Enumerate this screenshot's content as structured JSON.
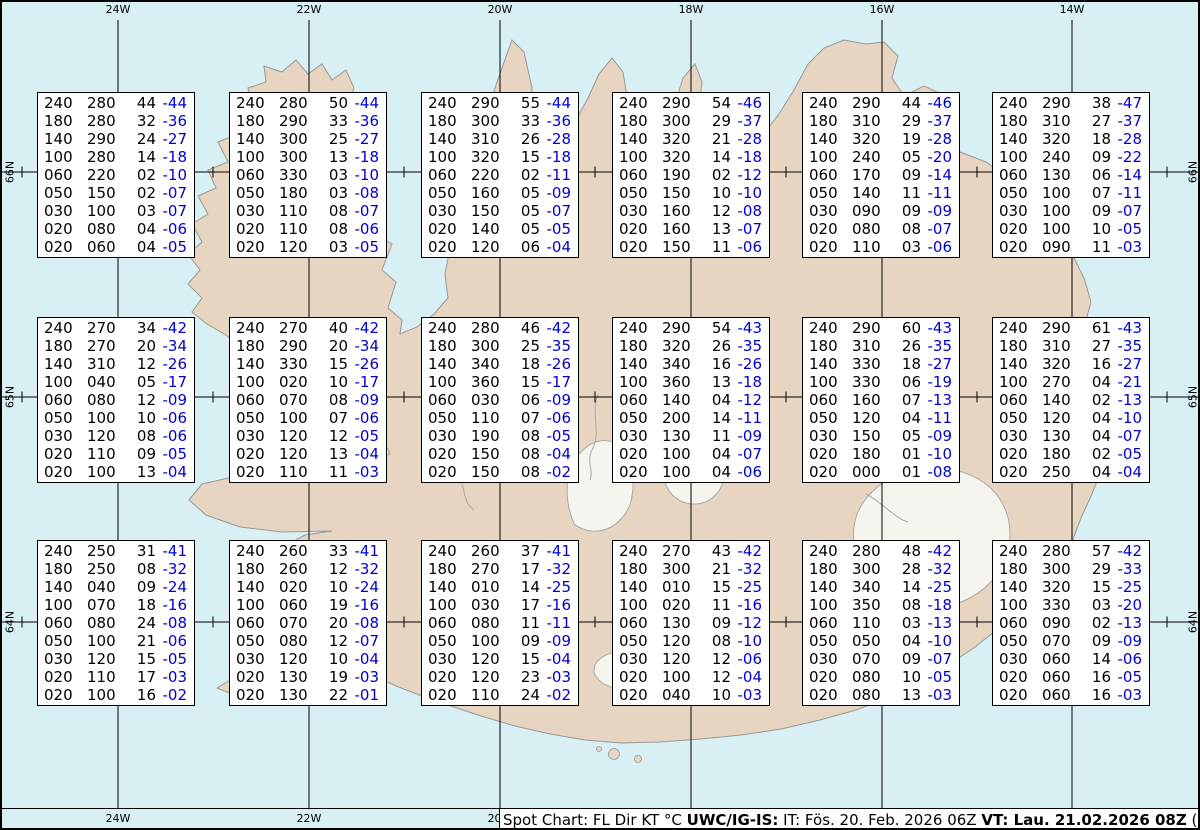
{
  "title": "Spot Chart: FL Dir KT °C",
  "colors": {
    "water": "#d8eff3",
    "land": "#e8d5c1",
    "coast": "#999999",
    "glacier": "#f6f4ee",
    "grid": "#000000",
    "temp": "#0000cc",
    "text": "#000000"
  },
  "axes": {
    "lon_labels": [
      "24W",
      "22W",
      "20W",
      "18W",
      "16W",
      "14W"
    ],
    "lat_labels": [
      "66N",
      "65N",
      "64N"
    ]
  },
  "footer": {
    "segments": [
      {
        "text": "Spot Chart: FL Dir KT °C ",
        "bold": false
      },
      {
        "text": "UWC/IG-IS:",
        "bold": true
      },
      {
        "text": " IT: Fös. 20. Feb. 2026 06Z ",
        "bold": false
      },
      {
        "text": "VT: Lau. 21.02.2026 08Z",
        "bold": true
      },
      {
        "text": " (+26 h)",
        "bold": false
      }
    ]
  },
  "chart_data": {
    "type": "table",
    "title": "Spot Chart: FL Dir KT °C",
    "columns": [
      "FL",
      "Dir",
      "KT",
      "Temp°C"
    ],
    "issue_time": "Fös. 20. Feb. 2026 06Z",
    "valid_time": "Lau. 21.02.2026 08Z (+26 h)",
    "grid": {
      "lons": [
        "24W",
        "22W",
        "20W",
        "18W",
        "16W",
        "14W"
      ],
      "lats": [
        "66N",
        "65N",
        "64N"
      ]
    },
    "stations": [
      {
        "lat": "66N",
        "lon": "24W",
        "values": [
          [
            "240",
            "280",
            "44",
            "-44"
          ],
          [
            "180",
            "280",
            "32",
            "-36"
          ],
          [
            "140",
            "290",
            "24",
            "-27"
          ],
          [
            "100",
            "280",
            "14",
            "-18"
          ],
          [
            "060",
            "220",
            "02",
            "-10"
          ],
          [
            "050",
            "150",
            "02",
            "-07"
          ],
          [
            "030",
            "100",
            "03",
            "-07"
          ],
          [
            "020",
            "080",
            "04",
            "-06"
          ],
          [
            "020",
            "060",
            "04",
            "-05"
          ]
        ]
      },
      {
        "lat": "66N",
        "lon": "22W",
        "values": [
          [
            "240",
            "280",
            "50",
            "-44"
          ],
          [
            "180",
            "290",
            "33",
            "-36"
          ],
          [
            "140",
            "300",
            "25",
            "-27"
          ],
          [
            "100",
            "300",
            "13",
            "-18"
          ],
          [
            "060",
            "330",
            "03",
            "-10"
          ],
          [
            "050",
            "180",
            "03",
            "-08"
          ],
          [
            "030",
            "110",
            "08",
            "-07"
          ],
          [
            "020",
            "110",
            "08",
            "-06"
          ],
          [
            "020",
            "120",
            "03",
            "-05"
          ]
        ]
      },
      {
        "lat": "66N",
        "lon": "20W",
        "values": [
          [
            "240",
            "290",
            "55",
            "-44"
          ],
          [
            "180",
            "300",
            "33",
            "-36"
          ],
          [
            "140",
            "310",
            "26",
            "-28"
          ],
          [
            "100",
            "320",
            "15",
            "-18"
          ],
          [
            "060",
            "220",
            "02",
            "-11"
          ],
          [
            "050",
            "160",
            "05",
            "-09"
          ],
          [
            "030",
            "150",
            "05",
            "-07"
          ],
          [
            "020",
            "140",
            "05",
            "-05"
          ],
          [
            "020",
            "120",
            "06",
            "-04"
          ]
        ]
      },
      {
        "lat": "66N",
        "lon": "18W",
        "values": [
          [
            "240",
            "290",
            "54",
            "-46"
          ],
          [
            "180",
            "300",
            "29",
            "-37"
          ],
          [
            "140",
            "320",
            "21",
            "-28"
          ],
          [
            "100",
            "320",
            "14",
            "-18"
          ],
          [
            "060",
            "190",
            "02",
            "-12"
          ],
          [
            "050",
            "150",
            "10",
            "-10"
          ],
          [
            "030",
            "160",
            "12",
            "-08"
          ],
          [
            "020",
            "160",
            "13",
            "-07"
          ],
          [
            "020",
            "150",
            "11",
            "-06"
          ]
        ]
      },
      {
        "lat": "66N",
        "lon": "16W",
        "values": [
          [
            "240",
            "290",
            "44",
            "-46"
          ],
          [
            "180",
            "310",
            "29",
            "-37"
          ],
          [
            "140",
            "320",
            "19",
            "-28"
          ],
          [
            "100",
            "240",
            "05",
            "-20"
          ],
          [
            "060",
            "170",
            "09",
            "-14"
          ],
          [
            "050",
            "140",
            "11",
            "-11"
          ],
          [
            "030",
            "090",
            "09",
            "-09"
          ],
          [
            "020",
            "080",
            "08",
            "-07"
          ],
          [
            "020",
            "110",
            "03",
            "-06"
          ]
        ]
      },
      {
        "lat": "66N",
        "lon": "14W",
        "values": [
          [
            "240",
            "290",
            "38",
            "-47"
          ],
          [
            "180",
            "310",
            "27",
            "-37"
          ],
          [
            "140",
            "320",
            "18",
            "-28"
          ],
          [
            "100",
            "240",
            "09",
            "-22"
          ],
          [
            "060",
            "130",
            "06",
            "-14"
          ],
          [
            "050",
            "100",
            "07",
            "-11"
          ],
          [
            "030",
            "100",
            "09",
            "-07"
          ],
          [
            "020",
            "100",
            "10",
            "-05"
          ],
          [
            "020",
            "090",
            "11",
            "-03"
          ]
        ]
      },
      {
        "lat": "65N",
        "lon": "24W",
        "values": [
          [
            "240",
            "270",
            "34",
            "-42"
          ],
          [
            "180",
            "270",
            "20",
            "-34"
          ],
          [
            "140",
            "310",
            "12",
            "-26"
          ],
          [
            "100",
            "040",
            "05",
            "-17"
          ],
          [
            "060",
            "080",
            "12",
            "-09"
          ],
          [
            "050",
            "100",
            "10",
            "-06"
          ],
          [
            "030",
            "120",
            "08",
            "-06"
          ],
          [
            "020",
            "110",
            "09",
            "-05"
          ],
          [
            "020",
            "100",
            "13",
            "-04"
          ]
        ]
      },
      {
        "lat": "65N",
        "lon": "22W",
        "values": [
          [
            "240",
            "270",
            "40",
            "-42"
          ],
          [
            "180",
            "290",
            "20",
            "-34"
          ],
          [
            "140",
            "330",
            "15",
            "-26"
          ],
          [
            "100",
            "020",
            "10",
            "-17"
          ],
          [
            "060",
            "070",
            "08",
            "-09"
          ],
          [
            "050",
            "100",
            "07",
            "-06"
          ],
          [
            "030",
            "120",
            "12",
            "-05"
          ],
          [
            "020",
            "120",
            "13",
            "-04"
          ],
          [
            "020",
            "110",
            "11",
            "-03"
          ]
        ]
      },
      {
        "lat": "65N",
        "lon": "20W",
        "values": [
          [
            "240",
            "280",
            "46",
            "-42"
          ],
          [
            "180",
            "300",
            "25",
            "-35"
          ],
          [
            "140",
            "340",
            "18",
            "-26"
          ],
          [
            "100",
            "360",
            "15",
            "-17"
          ],
          [
            "060",
            "030",
            "06",
            "-09"
          ],
          [
            "050",
            "110",
            "07",
            "-06"
          ],
          [
            "030",
            "190",
            "08",
            "-05"
          ],
          [
            "020",
            "150",
            "08",
            "-04"
          ],
          [
            "020",
            "150",
            "08",
            "-02"
          ]
        ]
      },
      {
        "lat": "65N",
        "lon": "18W",
        "values": [
          [
            "240",
            "290",
            "54",
            "-43"
          ],
          [
            "180",
            "320",
            "26",
            "-35"
          ],
          [
            "140",
            "340",
            "16",
            "-26"
          ],
          [
            "100",
            "360",
            "13",
            "-18"
          ],
          [
            "060",
            "140",
            "04",
            "-12"
          ],
          [
            "050",
            "200",
            "14",
            "-11"
          ],
          [
            "030",
            "130",
            "11",
            "-09"
          ],
          [
            "020",
            "100",
            "04",
            "-07"
          ],
          [
            "020",
            "100",
            "04",
            "-06"
          ]
        ]
      },
      {
        "lat": "65N",
        "lon": "16W",
        "values": [
          [
            "240",
            "290",
            "60",
            "-43"
          ],
          [
            "180",
            "310",
            "26",
            "-35"
          ],
          [
            "140",
            "330",
            "18",
            "-27"
          ],
          [
            "100",
            "330",
            "06",
            "-19"
          ],
          [
            "060",
            "160",
            "07",
            "-13"
          ],
          [
            "050",
            "120",
            "04",
            "-11"
          ],
          [
            "030",
            "150",
            "05",
            "-09"
          ],
          [
            "020",
            "180",
            "01",
            "-10"
          ],
          [
            "020",
            "000",
            "01",
            "-08"
          ]
        ]
      },
      {
        "lat": "65N",
        "lon": "14W",
        "values": [
          [
            "240",
            "290",
            "61",
            "-43"
          ],
          [
            "180",
            "310",
            "27",
            "-35"
          ],
          [
            "140",
            "320",
            "16",
            "-27"
          ],
          [
            "100",
            "270",
            "04",
            "-21"
          ],
          [
            "060",
            "140",
            "02",
            "-13"
          ],
          [
            "050",
            "120",
            "04",
            "-10"
          ],
          [
            "030",
            "130",
            "04",
            "-07"
          ],
          [
            "020",
            "180",
            "02",
            "-05"
          ],
          [
            "020",
            "250",
            "04",
            "-04"
          ]
        ]
      },
      {
        "lat": "64N",
        "lon": "24W",
        "values": [
          [
            "240",
            "250",
            "31",
            "-41"
          ],
          [
            "180",
            "250",
            "08",
            "-32"
          ],
          [
            "140",
            "040",
            "09",
            "-24"
          ],
          [
            "100",
            "070",
            "18",
            "-16"
          ],
          [
            "060",
            "080",
            "24",
            "-08"
          ],
          [
            "050",
            "100",
            "21",
            "-06"
          ],
          [
            "030",
            "120",
            "15",
            "-05"
          ],
          [
            "020",
            "110",
            "17",
            "-03"
          ],
          [
            "020",
            "100",
            "16",
            "-02"
          ]
        ]
      },
      {
        "lat": "64N",
        "lon": "22W",
        "values": [
          [
            "240",
            "260",
            "33",
            "-41"
          ],
          [
            "180",
            "260",
            "12",
            "-32"
          ],
          [
            "140",
            "020",
            "10",
            "-24"
          ],
          [
            "100",
            "060",
            "19",
            "-16"
          ],
          [
            "060",
            "070",
            "20",
            "-08"
          ],
          [
            "050",
            "080",
            "12",
            "-07"
          ],
          [
            "030",
            "120",
            "10",
            "-04"
          ],
          [
            "020",
            "130",
            "19",
            "-03"
          ],
          [
            "020",
            "130",
            "22",
            "-01"
          ]
        ]
      },
      {
        "lat": "64N",
        "lon": "20W",
        "values": [
          [
            "240",
            "260",
            "37",
            "-41"
          ],
          [
            "180",
            "270",
            "17",
            "-32"
          ],
          [
            "140",
            "010",
            "14",
            "-25"
          ],
          [
            "100",
            "030",
            "17",
            "-16"
          ],
          [
            "060",
            "080",
            "11",
            "-11"
          ],
          [
            "050",
            "100",
            "09",
            "-09"
          ],
          [
            "030",
            "120",
            "15",
            "-04"
          ],
          [
            "020",
            "120",
            "23",
            "-03"
          ],
          [
            "020",
            "110",
            "24",
            "-02"
          ]
        ]
      },
      {
        "lat": "64N",
        "lon": "18W",
        "values": [
          [
            "240",
            "270",
            "43",
            "-42"
          ],
          [
            "180",
            "300",
            "21",
            "-32"
          ],
          [
            "140",
            "010",
            "15",
            "-25"
          ],
          [
            "100",
            "020",
            "11",
            "-16"
          ],
          [
            "060",
            "130",
            "09",
            "-12"
          ],
          [
            "050",
            "120",
            "08",
            "-10"
          ],
          [
            "030",
            "120",
            "12",
            "-06"
          ],
          [
            "020",
            "100",
            "12",
            "-04"
          ],
          [
            "020",
            "040",
            "10",
            "-03"
          ]
        ]
      },
      {
        "lat": "64N",
        "lon": "16W",
        "values": [
          [
            "240",
            "280",
            "48",
            "-42"
          ],
          [
            "180",
            "300",
            "28",
            "-32"
          ],
          [
            "140",
            "340",
            "14",
            "-25"
          ],
          [
            "100",
            "350",
            "08",
            "-18"
          ],
          [
            "060",
            "110",
            "03",
            "-13"
          ],
          [
            "050",
            "050",
            "04",
            "-10"
          ],
          [
            "030",
            "070",
            "09",
            "-07"
          ],
          [
            "020",
            "080",
            "10",
            "-05"
          ],
          [
            "020",
            "080",
            "13",
            "-03"
          ]
        ]
      },
      {
        "lat": "64N",
        "lon": "14W",
        "values": [
          [
            "240",
            "280",
            "57",
            "-42"
          ],
          [
            "180",
            "300",
            "29",
            "-33"
          ],
          [
            "140",
            "320",
            "15",
            "-25"
          ],
          [
            "100",
            "330",
            "03",
            "-20"
          ],
          [
            "060",
            "090",
            "02",
            "-13"
          ],
          [
            "050",
            "070",
            "09",
            "-09"
          ],
          [
            "030",
            "060",
            "14",
            "-06"
          ],
          [
            "020",
            "060",
            "16",
            "-05"
          ],
          [
            "020",
            "060",
            "16",
            "-03"
          ]
        ]
      }
    ]
  }
}
